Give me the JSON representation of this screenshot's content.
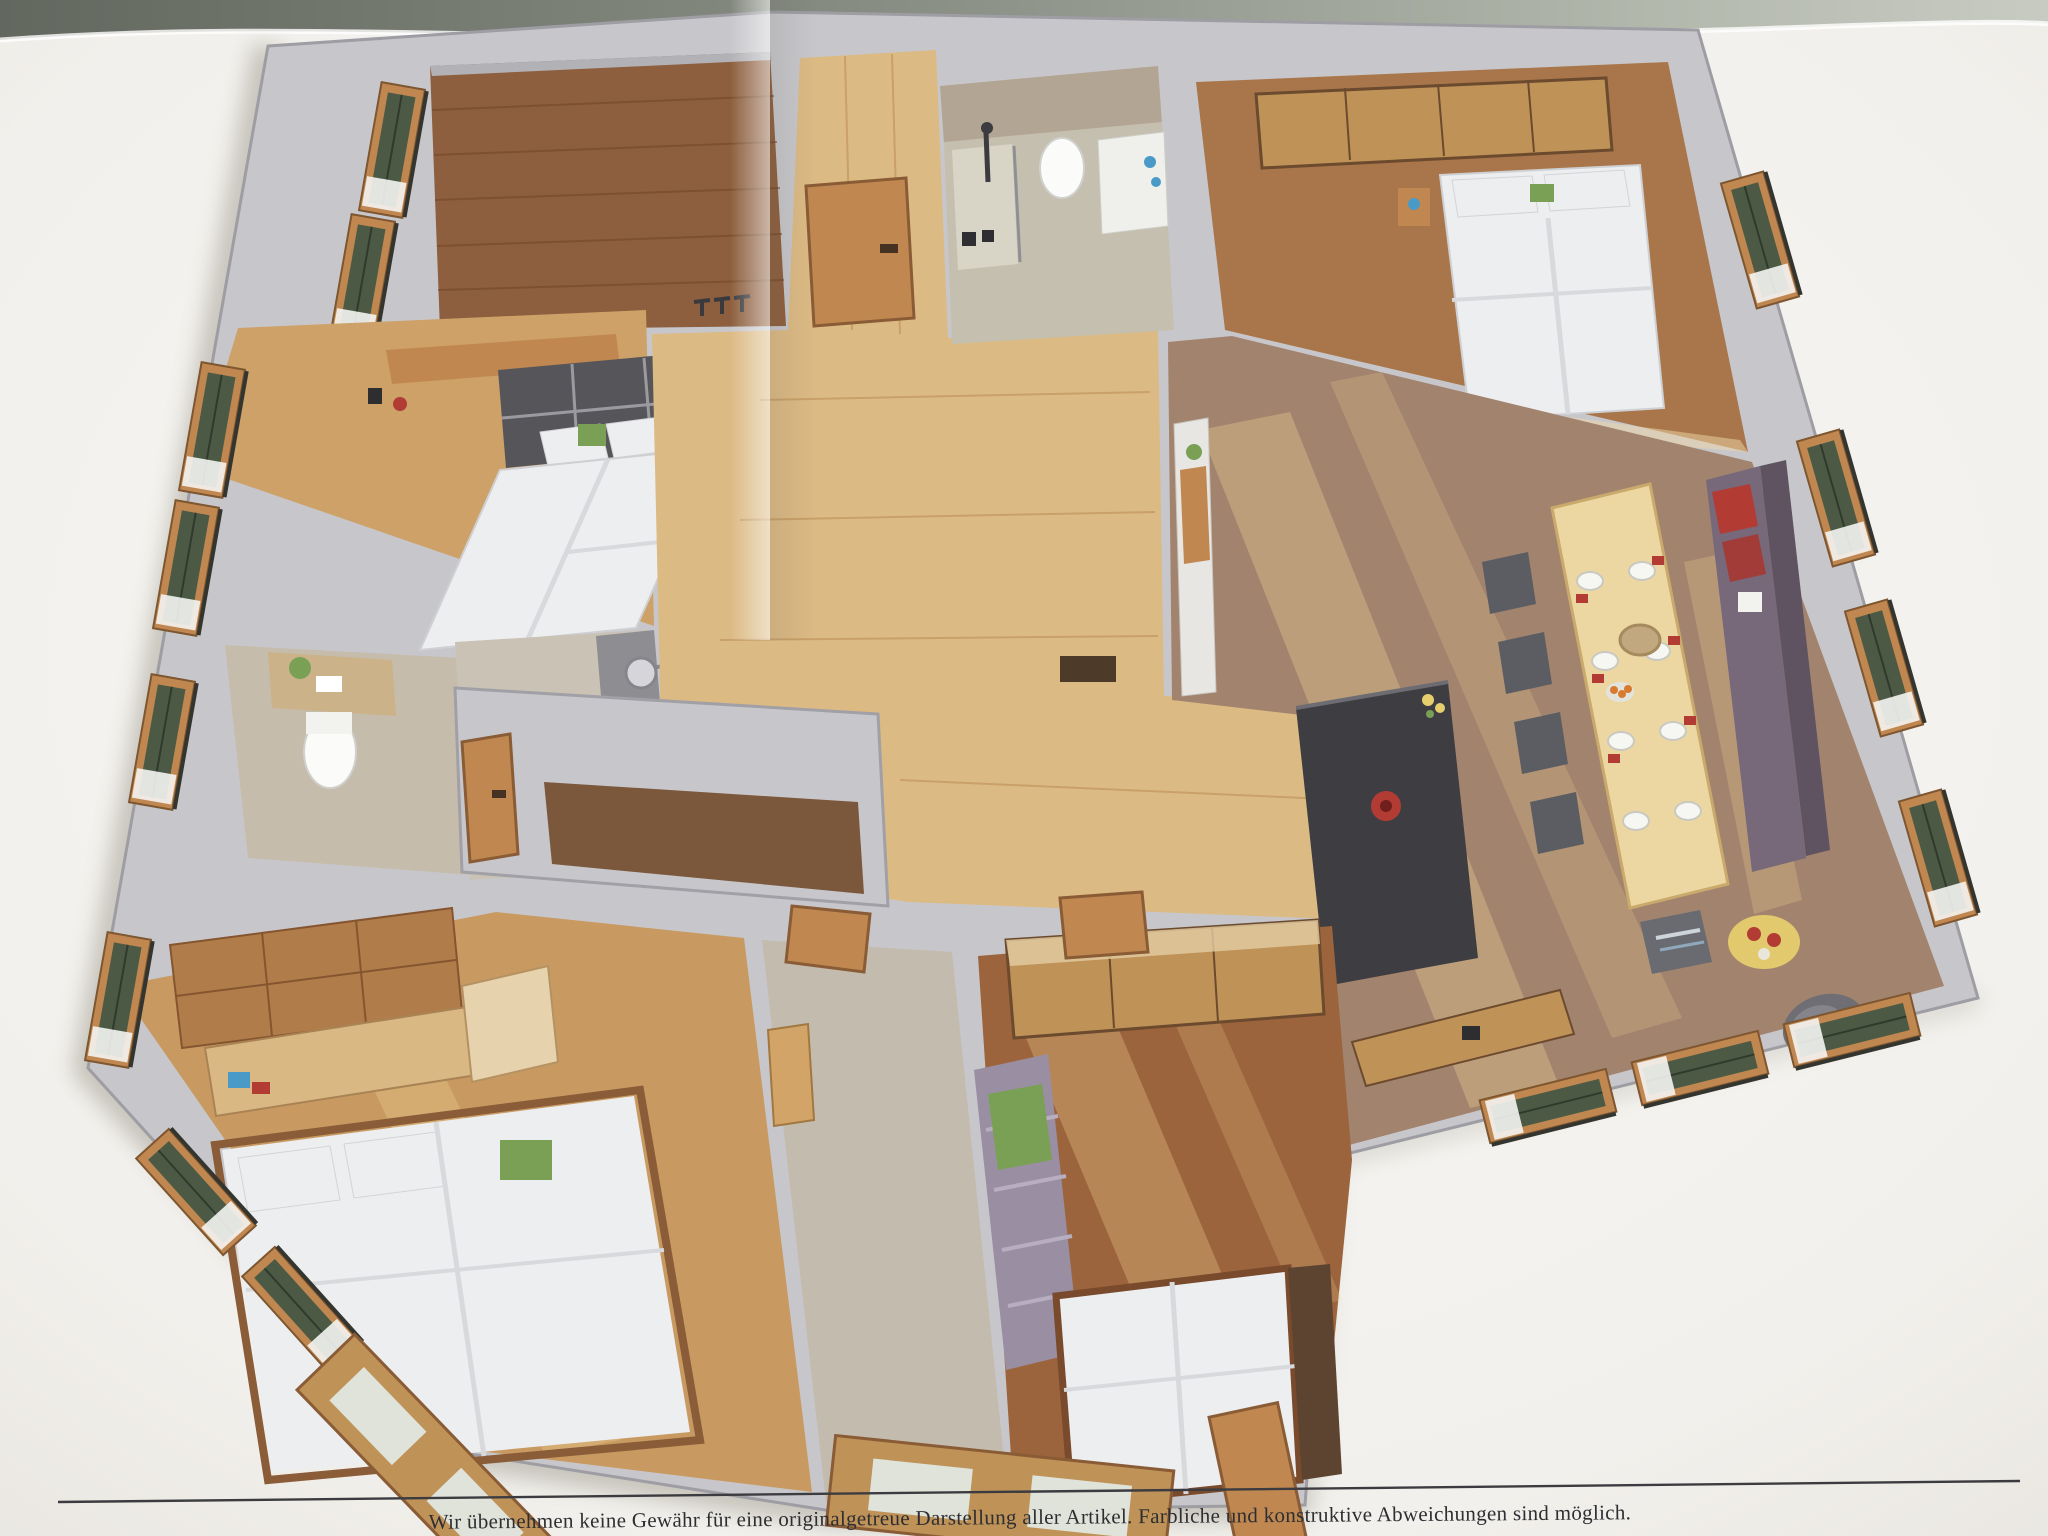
{
  "photo": {
    "type": "photograph of a printed 3D floor plan (dollhouse top view)",
    "disclaimer": "Wir übernehmen keine Gewähr für eine originalgetreue Darstellung aller Artikel. Farbliche und konstruktive Abweichungen sind möglich."
  },
  "palette": {
    "backdrop_left": "#6e7369",
    "backdrop_right": "#b2b7ac",
    "paper": "#f5f3ef",
    "paper_edge": "#e4e1da",
    "wall": "#c7c7cb",
    "wall_edge": "#9d9da3",
    "wood_light": "#dcba84",
    "wood_mid": "#bf9258",
    "wood_dark": "#8d5f3e",
    "floor_taupe": "#a2836e",
    "tile": "#c6bcab",
    "island": "#3e3e42",
    "wood_furniture": "#c08850",
    "window_green": "#4c5a45",
    "bed_white": "#edeef0",
    "bench_mauve": "#77687a",
    "accent_red": "#b23c34",
    "accent_green": "#7aa055",
    "accent_blue": "#4a9ac8",
    "accent_yellow": "#e7cf6d",
    "sun": "#f3d795",
    "text": "#2e2e32",
    "rule": "#3c3c40"
  }
}
